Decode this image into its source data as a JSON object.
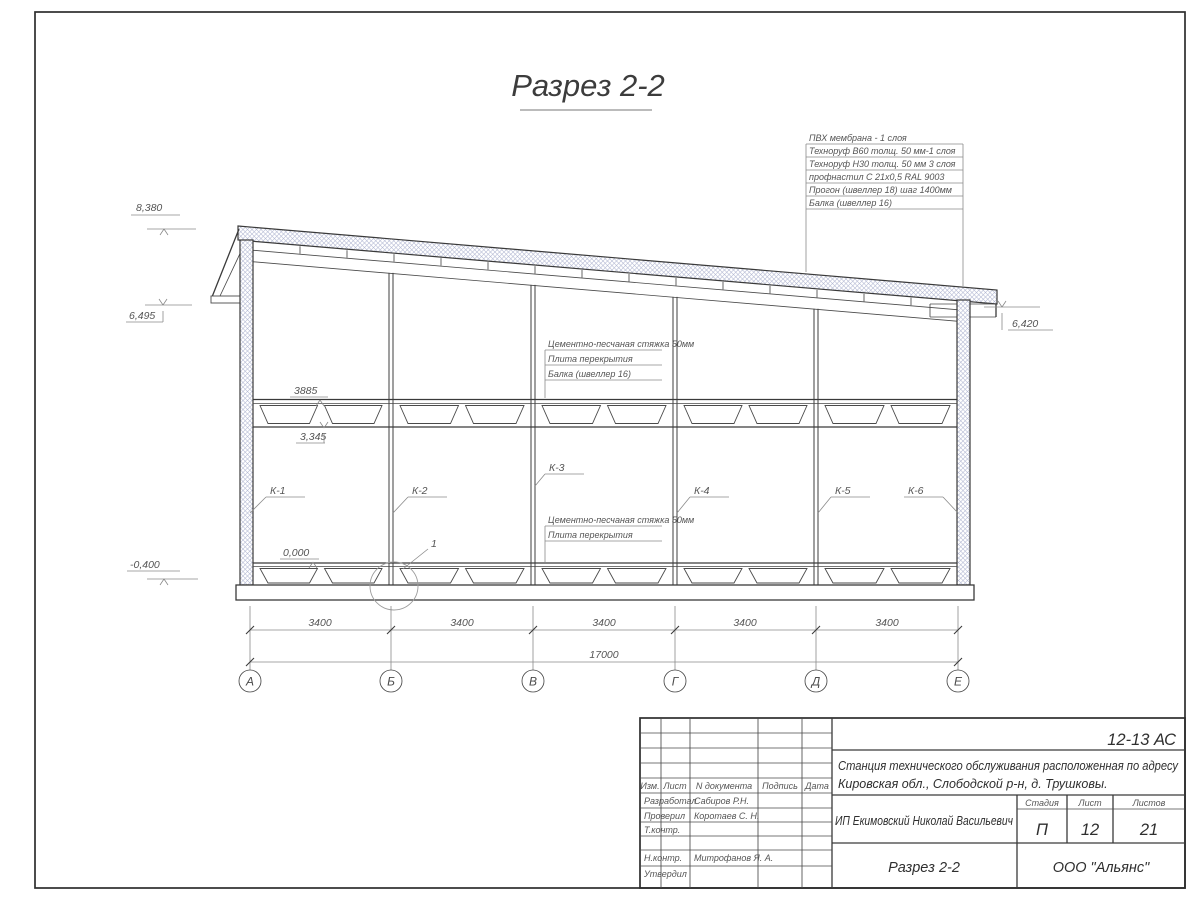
{
  "title": {
    "text": "Разрез 2-2"
  },
  "roof_layers": [
    "ПВХ мембрана - 1 слоя",
    "Техноруф В60 толщ. 50 мм-1 слоя",
    "Техноруф Н30 толщ. 50 мм 3 слоя",
    "профнастил С 21х0,5 RAL 9003",
    "Прогон (швеллер 18) шаг 1400мм",
    "Балка (швеллер 16)"
  ],
  "floor_annotations_mid": [
    "Цементно-песчаная стяжка 50мм",
    "Плита перекрытия",
    "Балка (швеллер 16)"
  ],
  "floor_annotations_bottom": [
    "Цементно-песчаная стяжка 50мм",
    "Плита перекрытия"
  ],
  "elevations": {
    "m8380": "8,380",
    "m6495": "6,495",
    "m0400": "-0,400",
    "m6420": "6,420",
    "m0000": "0,000",
    "m3885": "3885",
    "m3345": "3,345"
  },
  "columns": [
    "К-1",
    "К-2",
    "К-3",
    "К-4",
    "К-5",
    "К-6"
  ],
  "detail_marker": "1",
  "dimensions": {
    "bays": [
      "3400",
      "3400",
      "3400",
      "3400",
      "3400"
    ],
    "total": "17000"
  },
  "axes": [
    "А",
    "Б",
    "В",
    "Г",
    "Д",
    "Е"
  ],
  "titleblock": {
    "doc_code": "12-13 АС",
    "project_line1": "Станция технического обслуживания расположенная по адресу",
    "project_line2": "Кировская обл., Слободской р-н, д. Трушковы.",
    "client": "ИП Екимовский Николай Васильевич",
    "sheet_title": "Разрез 2-2",
    "organization": "ООО \"Альянс\"",
    "stage_label": "Стадия",
    "stage": "П",
    "sheet_label": "Лист",
    "sheet": "12",
    "sheets_label": "Листов",
    "sheets": "21",
    "header_cols": [
      "Изм.",
      "Лист",
      "N документа",
      "Подпись",
      "Дата"
    ],
    "roles": [
      {
        "role": "Разработал",
        "name": "Сабиров Р.Н."
      },
      {
        "role": "Проверил",
        "name": "Коротаев С. Н."
      },
      {
        "role": "Т.контр.",
        "name": ""
      },
      {
        "role": "",
        "name": ""
      },
      {
        "role": "Н.контр.",
        "name": "Митрофанов Я. А."
      },
      {
        "role": "Утвердил",
        "name": ""
      }
    ]
  },
  "colors": {
    "line_main": "#3a3a3a",
    "line_thin": "#8a8a8a",
    "hatch": "#b4b9d4",
    "text": "#555555"
  }
}
